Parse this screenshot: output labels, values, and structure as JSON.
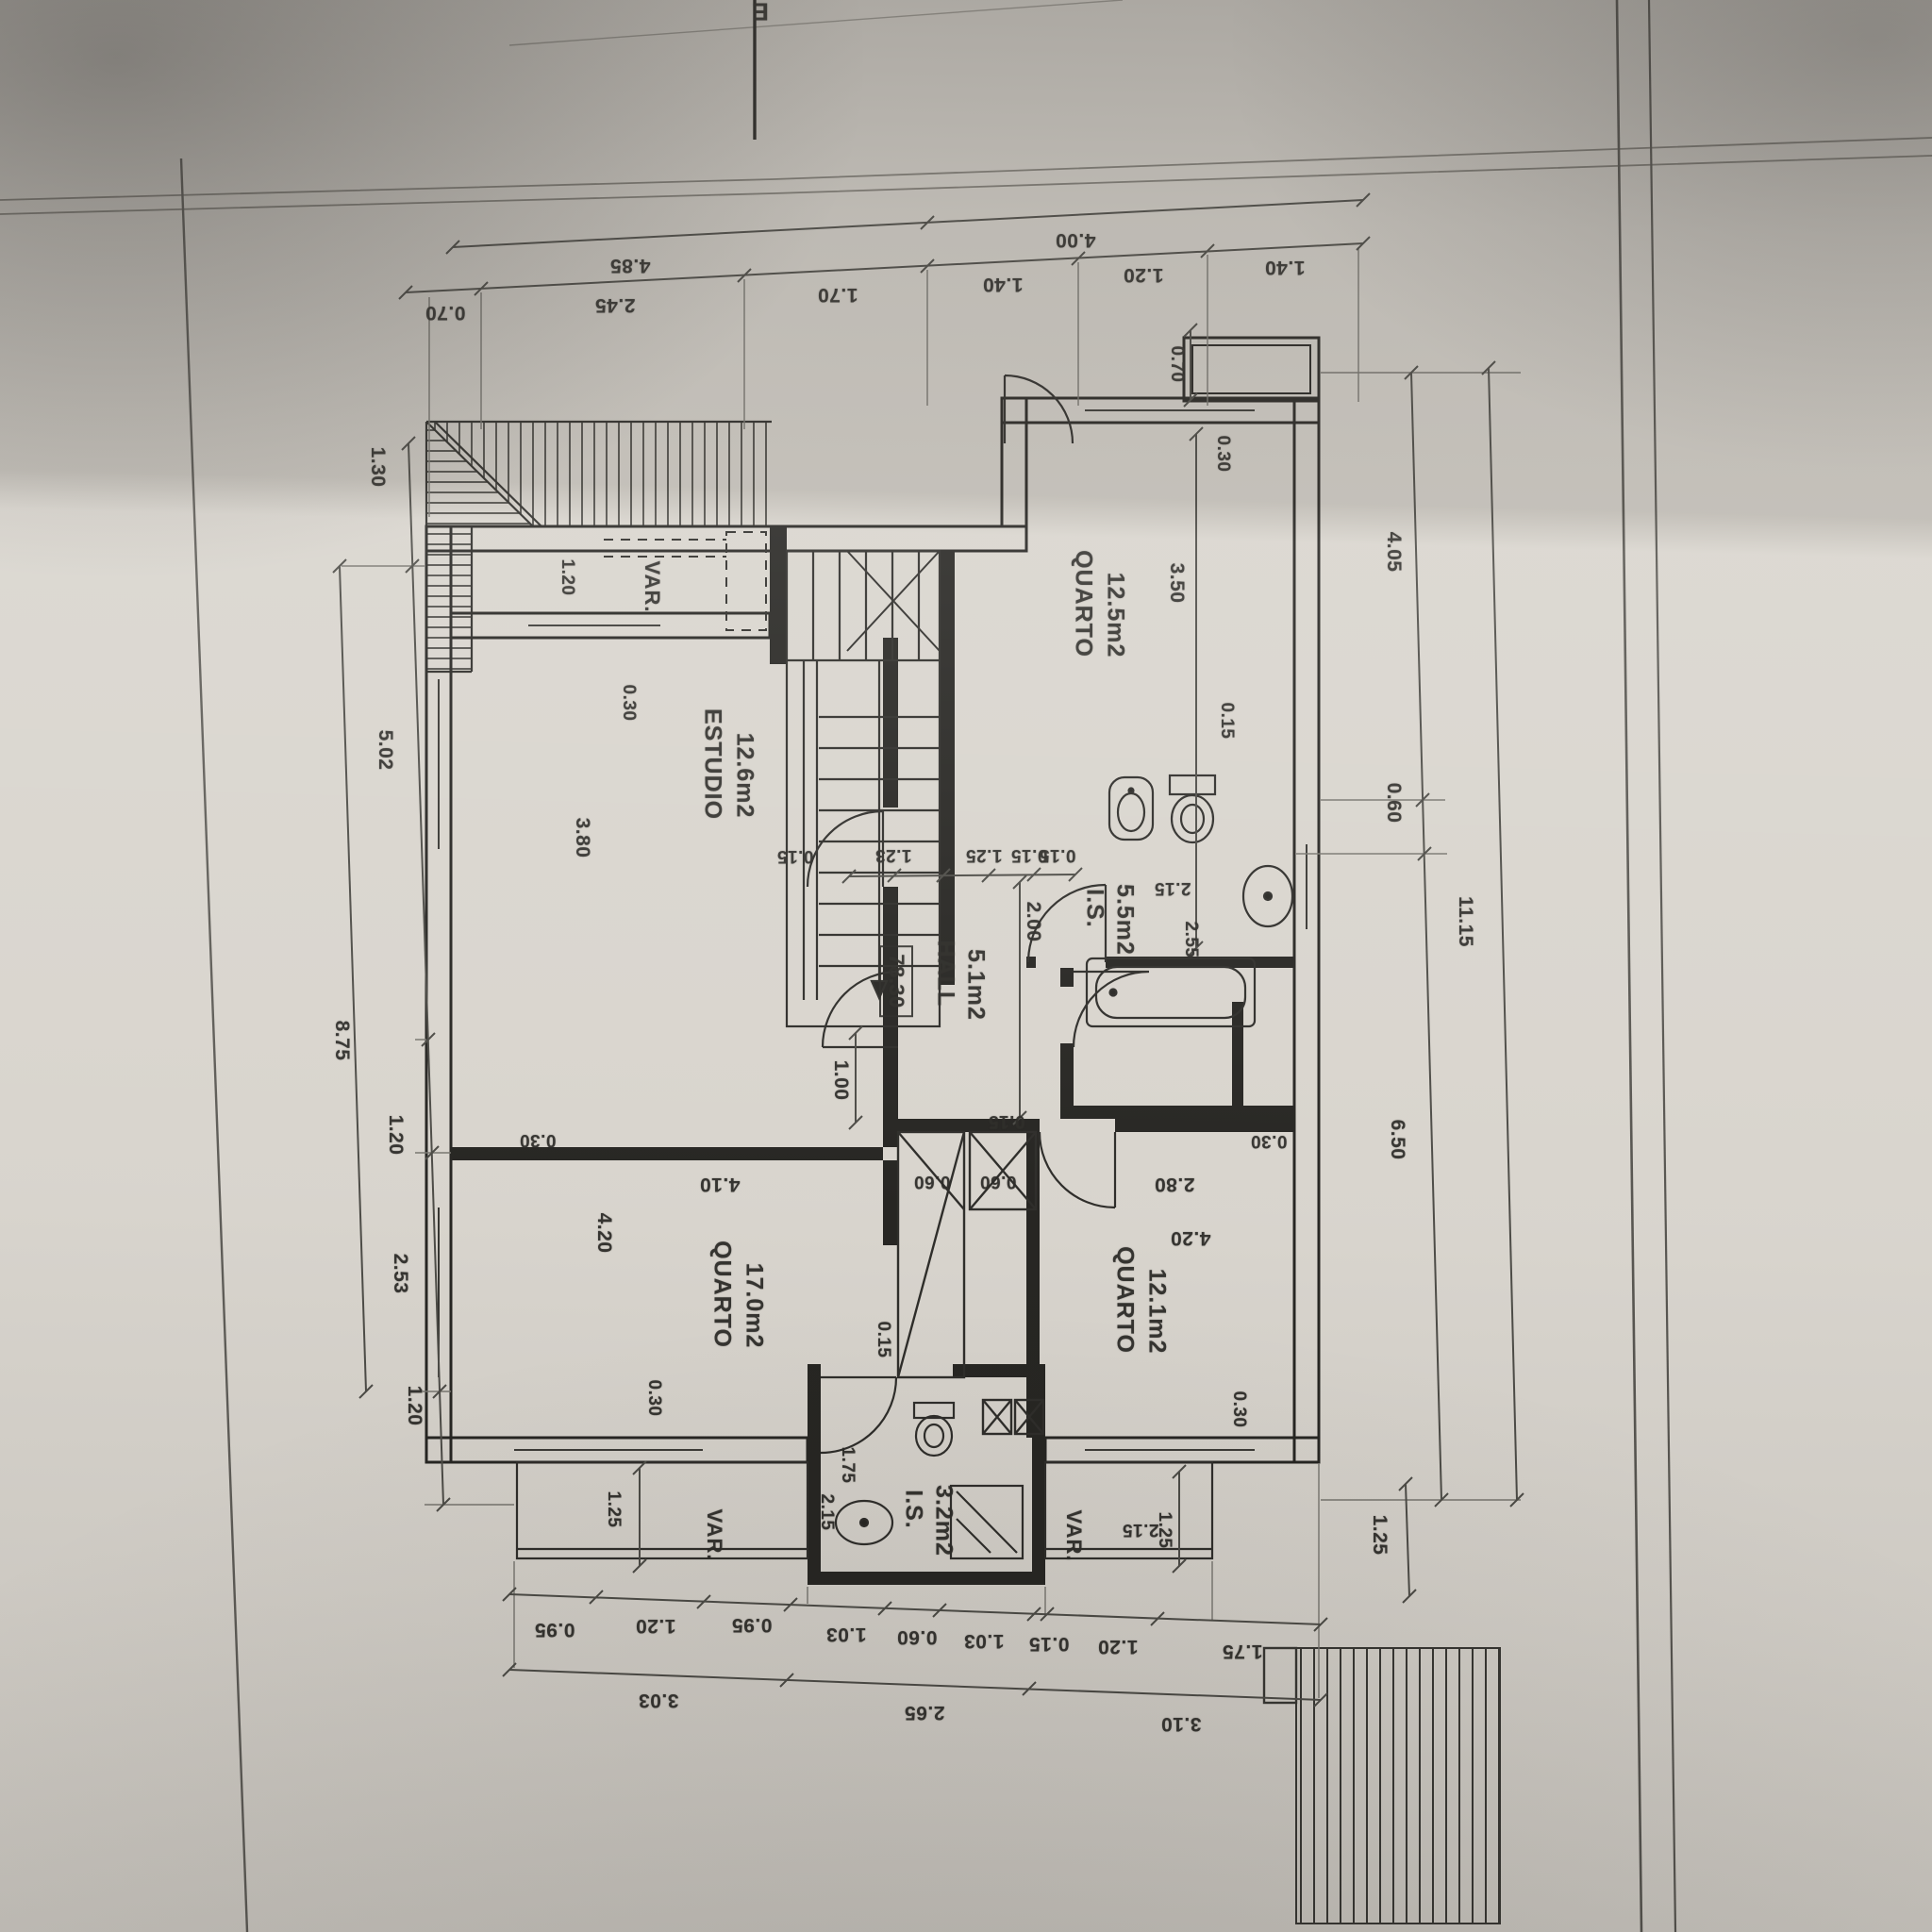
{
  "sheet": {
    "corner_letter": "E"
  },
  "rooms": {
    "quarto1": {
      "name": "QUARTO",
      "area": "12.5m2"
    },
    "estudio": {
      "name": "ESTUDIO",
      "area": "12.6m2"
    },
    "hall": {
      "name": "HALL",
      "area": "5.1m2"
    },
    "is1": {
      "name": "I.S.",
      "area": "5.5m2"
    },
    "quarto2": {
      "name": "QUARTO",
      "area": "17.0m2"
    },
    "quarto3": {
      "name": "QUARTO",
      "area": "12.1m2"
    },
    "is2": {
      "name": "I.S.",
      "area": "3.2m2"
    },
    "var_top": "VAR.",
    "var_bottom_left": "VAR.",
    "var_bottom_right": "VAR.",
    "total_area": "78.30"
  },
  "dims": {
    "top_row_segments": [
      "0.70",
      "2.45",
      "1.70",
      "1.40",
      "1.20",
      "1.40"
    ],
    "top_row_totals": [
      "4.85",
      "4.00"
    ],
    "left_segments": [
      "1.30",
      "5.02",
      "1.20",
      "2.53",
      "1.20"
    ],
    "left_total": "8.75",
    "right_segments": [
      "4.05",
      "0.60",
      "6.50"
    ],
    "right_extra": "1.25",
    "right_total": "11.15",
    "bottom_segments": [
      "0.95",
      "1.20",
      "0.95",
      "1.03",
      "0.60",
      "1.03",
      "0.15",
      "1.20",
      "1.75"
    ],
    "bottom_totals": [
      "3.03",
      "2.65",
      "3.10"
    ],
    "interior": {
      "var_120": "1.20",
      "bal_070": "0.70",
      "est_030": "0.30",
      "est_380": "3.80",
      "est_015": "0.15",
      "st_123": "1.23",
      "st_125": "1.25",
      "st_015a": "0.15",
      "st_015b": "0.15",
      "cor_200": "2.00",
      "hall_100": "1.00",
      "hall_015": "0.15",
      "q1_350": "3.50",
      "q1_030": "0.30",
      "q1_015": "0.15",
      "is1_215": "2.15",
      "is1_255": "2.55",
      "q2_420": "4.20",
      "q2_410": "4.10",
      "q2_030a": "0.30",
      "q2_030b": "0.30",
      "q2_015": "0.15",
      "q2_175": "1.75",
      "w_060a": "0.60",
      "w_060b": "0.60",
      "q3_280": "2.80",
      "q3_420": "4.20",
      "q3_030a": "0.30",
      "q3_030b": "0.30",
      "varbl_125": "1.25",
      "varbl_215": "2.15",
      "varbr_215": "2.15",
      "varbr_125": "1.25"
    }
  }
}
